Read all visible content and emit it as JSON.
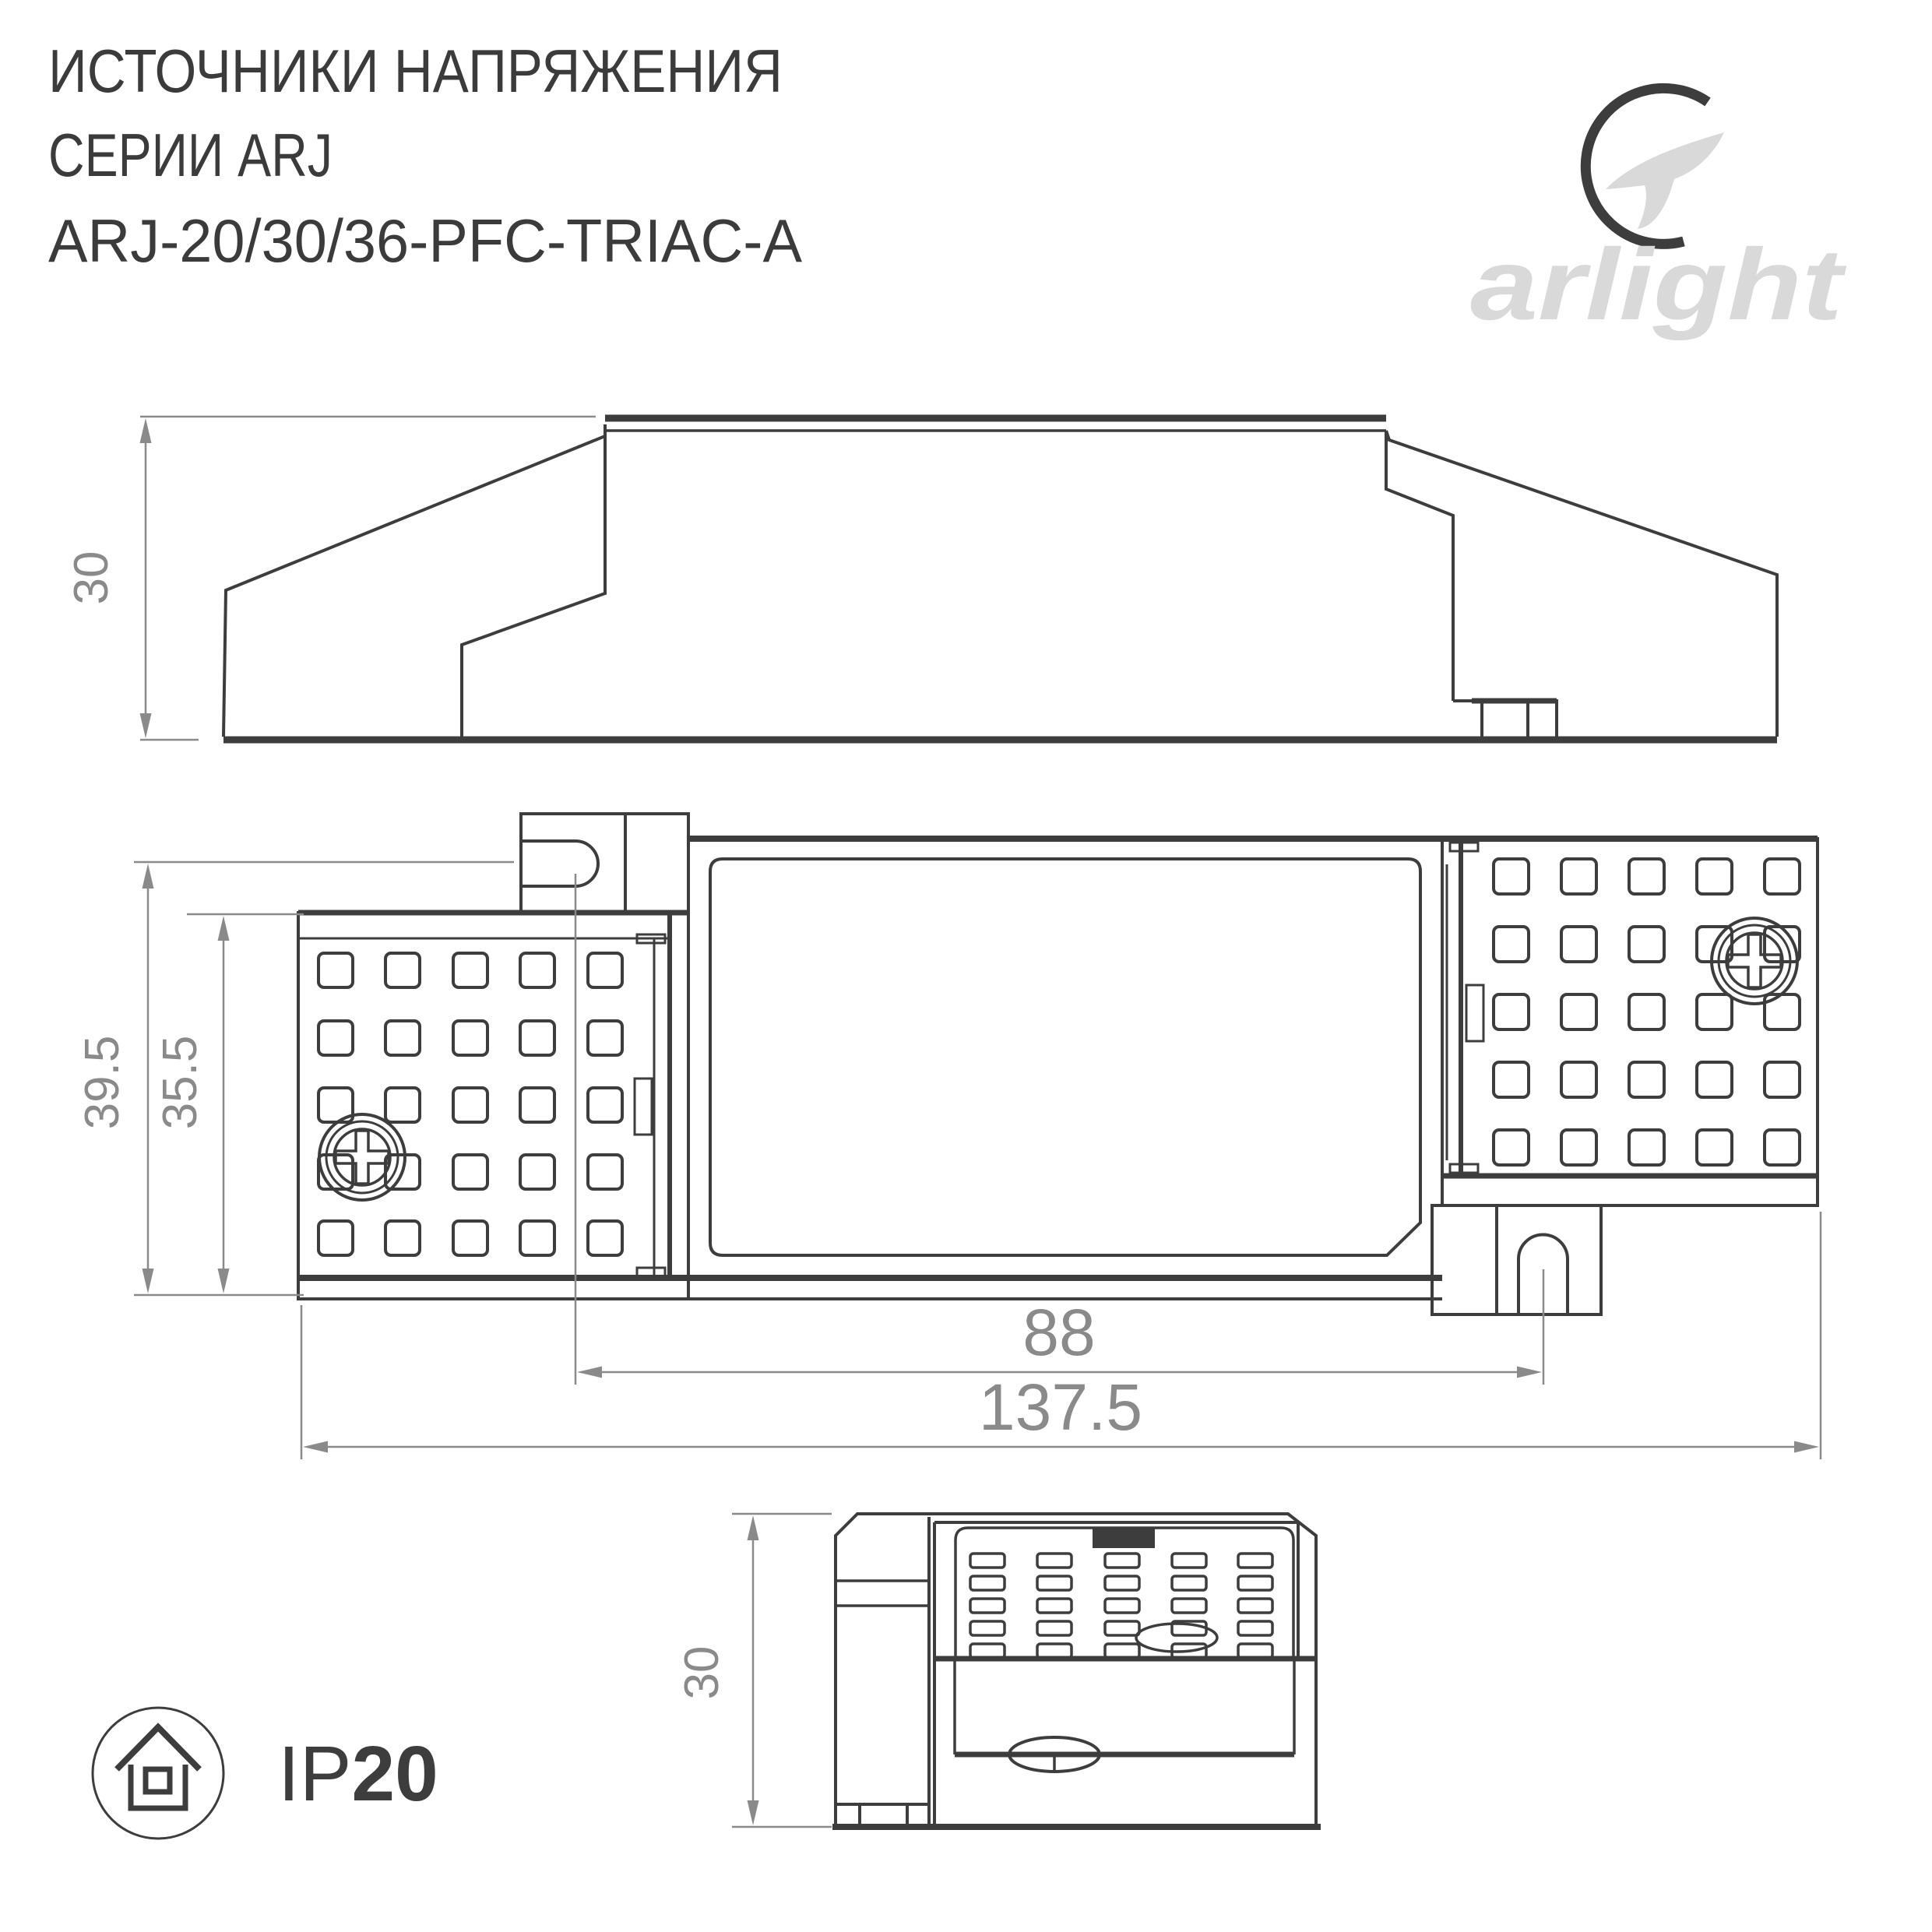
{
  "title": {
    "line1": "ИСТОЧНИКИ НАПРЯЖЕНИЯ",
    "line2": "СЕРИИ ARJ",
    "line3": "ARJ-20/30/36-PFC-TRIAC-A"
  },
  "logo": {
    "brand": "arlight"
  },
  "dimensions": {
    "side_height": "30",
    "overall_height": "39.5",
    "inner_height": "35.5",
    "mount_spacing": "88",
    "overall_length": "137.5",
    "end_height": "30"
  },
  "ip_rating": {
    "prefix": "IP",
    "value": "20"
  },
  "colors": {
    "line": "#3d3d3d",
    "dimension": "#8a8a8a",
    "logo": "#d9d9d9",
    "background": "#ffffff"
  }
}
